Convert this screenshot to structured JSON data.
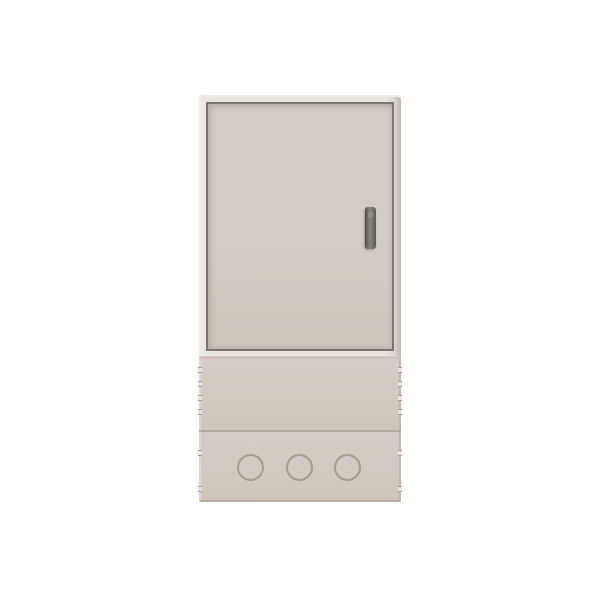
{
  "image": {
    "description": "3D product render of a beige freestanding outdoor electrical / fiber distribution cabinet shown from the front on a plain white background",
    "text_content": "none — the image contains no visible text, labels or numbers"
  },
  "cabinet": {
    "view": "front",
    "door": {
      "style": "single flush door outlined by a recessed dark gap line inside a light frame",
      "handle": {
        "type": "vertical bar handle with small lock detail",
        "position": "right side of door, mid height"
      }
    },
    "base": {
      "upper_band": {
        "vent_notches_per_side": 4
      },
      "lower_band": {
        "knockout_circles": 3,
        "vent_notches_per_side": 2
      }
    }
  },
  "colors": {
    "background": "#ffffff",
    "frame_light": "#e8e4de",
    "frame_highlight": "#f0ede8",
    "frame_shadow_edge": "#bfb7ad",
    "door_gap_line": "#7b756e",
    "door_panel": "#d3ccc4",
    "door_panel_dark": "#cdc5bc",
    "base_panel": "#d2cac1",
    "base_panel_dark": "#cec6bd",
    "divider_line": "#b2a99e",
    "bottom_edge": "#b6ada2",
    "knockout_ring": "#a69b8e",
    "handle_dark": "#5d5a56",
    "handle_mid": "#8a857f",
    "notch_light": "#e7e3dc",
    "notch_dark": "#a69c91"
  }
}
